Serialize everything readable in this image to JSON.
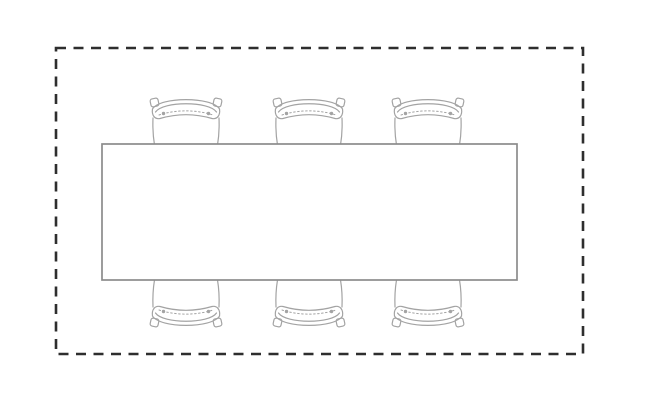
{
  "page": {
    "background": "#ffffff",
    "canvas_width": 660,
    "canvas_height": 400
  },
  "diagram": {
    "kind": "furniture-floor-plan",
    "description": "Top-down line drawing of a rectangular six-seat table centered inside a dashed rectangular boundary; three chairs tucked under the top edge and three mirrored chairs under the bottom edge.",
    "colors": {
      "background": "#ffffff",
      "boundary_stroke": "#2e2e2e",
      "table_stroke": "#8c8c8c",
      "table_fill": "#ffffff",
      "chair_stroke": "#a3a3a3"
    },
    "boundary": {
      "shape": "rectangle",
      "style": "dashed",
      "x": 56,
      "y": 48,
      "width": 527,
      "height": 306,
      "stroke_width": 2.6,
      "dash": [
        10,
        7.5
      ]
    },
    "table": {
      "shape": "rectangle",
      "x": 102,
      "y": 144,
      "width": 415,
      "height": 136,
      "stroke_width": 1.7
    },
    "chairs": {
      "count": 6,
      "chair_width": 72,
      "chair_depth": 53,
      "rows": [
        {
          "side": "top",
          "anchor_y": 92,
          "flipped": false,
          "centers_x": [
            186,
            309,
            428
          ]
        },
        {
          "side": "bottom",
          "anchor_y": 333,
          "flipped": true,
          "centers_x": [
            186,
            309,
            428
          ]
        }
      ]
    }
  }
}
